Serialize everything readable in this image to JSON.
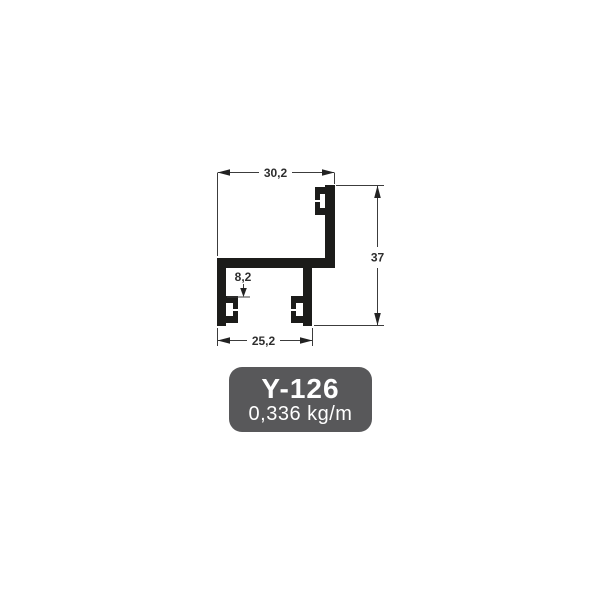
{
  "product": {
    "code": "Y-126",
    "weight": "0,336 kg/m"
  },
  "diagram": {
    "type": "aluminium-profile-cross-section",
    "dim_top_width": "30,2",
    "dim_height": "37",
    "dim_bottom_width": "25,2",
    "dim_notch_height": "8,2"
  },
  "colors": {
    "page_bg": "#ffffff",
    "profile_fill": "#1c1c1a",
    "dimension_line": "#3c3c3c",
    "badge_bg": "#58585a",
    "badge_text": "#ffffff"
  }
}
